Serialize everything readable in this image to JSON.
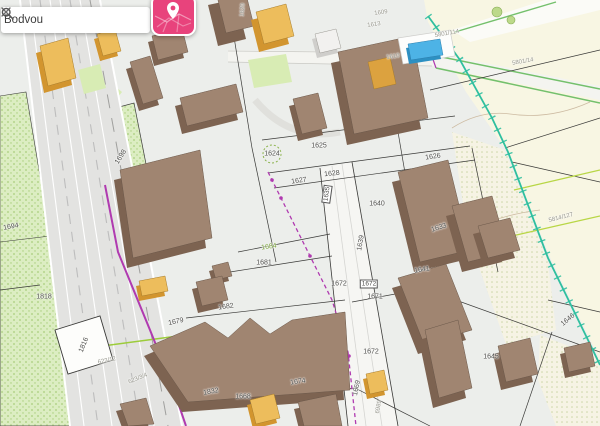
{
  "search": {
    "value": "Bodvou"
  },
  "toolbar": {
    "map_button_icon": "map-pin-icon",
    "clear_icon": "close-icon",
    "search_icon": "search-icon"
  },
  "map": {
    "labels": [
      {
        "text": "1698"
      },
      {
        "text": "1694"
      },
      {
        "text": "1818"
      },
      {
        "text": "1816"
      },
      {
        "text": "623/12"
      },
      {
        "text": "623/3/4"
      },
      {
        "text": "1832"
      },
      {
        "text": "1679"
      },
      {
        "text": "1682"
      },
      {
        "text": "1668"
      },
      {
        "text": "1674"
      },
      {
        "text": "1684"
      },
      {
        "text": "1681"
      },
      {
        "text": "1625"
      },
      {
        "text": "1624"
      },
      {
        "text": "1627"
      },
      {
        "text": "1628"
      },
      {
        "text": "1626"
      },
      {
        "text": "1640"
      },
      {
        "text": "1633"
      },
      {
        "text": "1635"
      },
      {
        "text": "1639"
      },
      {
        "text": "1641"
      },
      {
        "text": "1672"
      },
      {
        "text": "1672"
      },
      {
        "text": "1671"
      },
      {
        "text": "1672"
      },
      {
        "text": "1669"
      },
      {
        "text": "6989"
      },
      {
        "text": "1645"
      },
      {
        "text": "1646"
      },
      {
        "text": "5814/127"
      },
      {
        "text": "5801/114"
      },
      {
        "text": "5801/14"
      },
      {
        "text": "1609"
      },
      {
        "text": "1613"
      },
      {
        "text": "1620"
      },
      {
        "text": "1610"
      }
    ]
  },
  "colors": {
    "accent_pink": "#e8437c",
    "utility_purple": "#b03ab0",
    "railway_teal": "#2fbf9f",
    "building_brown": "#a08571",
    "building_brown_side": "#7d6351",
    "building_orange": "#edbd5c",
    "building_orange_side": "#d2952f",
    "pool_blue": "#4db3e6",
    "vegetation_green": "#dcedc2",
    "field_cream": "#f8f6e3"
  }
}
